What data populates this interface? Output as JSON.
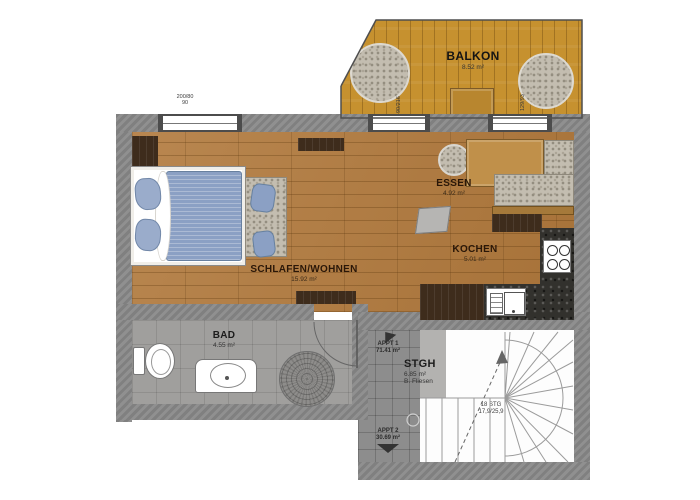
{
  "rooms": {
    "balkon": {
      "label": "BALKON",
      "area": "8.52 m²"
    },
    "essen": {
      "label": "ESSEN",
      "area": "4.92 m²"
    },
    "kochen": {
      "label": "KOCHEN",
      "area": "5.01 m²"
    },
    "wohnen": {
      "label": "SCHLAFEN/WOHNEN",
      "area": "15.92 m²"
    },
    "bad": {
      "label": "BAD",
      "area": "4.55 m²"
    },
    "stgh": {
      "label": "STGH",
      "area": "6.85 m²",
      "floor_note": "B. Fliesen"
    }
  },
  "apartments": {
    "appt1": {
      "label": "APPT 1",
      "area": "71.41 m²"
    },
    "appt2": {
      "label": "APPT 2",
      "area": "30.69 m²"
    }
  },
  "stairs": {
    "steps_label": "18 STG",
    "ratio_label": "17,9/25,9"
  },
  "dimensions": {
    "window_bedroom": "200/80",
    "window_bedroom_sill": "90",
    "door_balcony": "90/216",
    "window_kitchen": "129/93"
  },
  "colors": {
    "wood_floor": "#b1793c",
    "deck": "#c6912f",
    "wall": "#8a8a8a",
    "counter": "#32312d",
    "fabric_blue": "#8ba0c4",
    "gravel": "#c3bdb0"
  }
}
